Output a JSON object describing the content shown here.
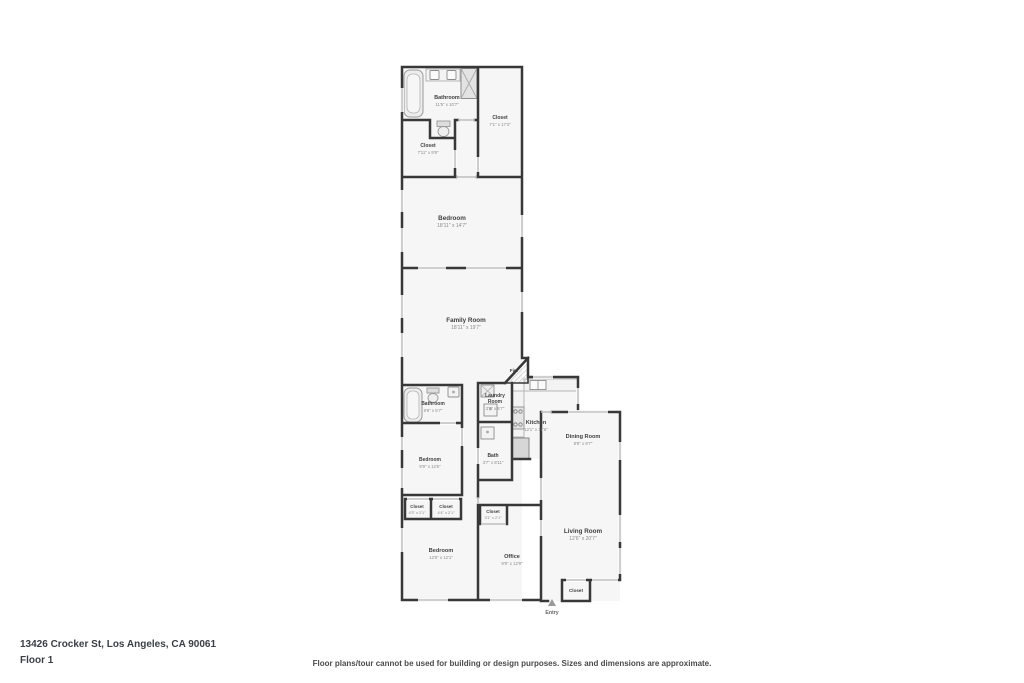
{
  "colors": {
    "wall": "#383838",
    "room_fill": "#f6f6f6",
    "window": "#cfcfcf",
    "door": "#bdbdbd",
    "label_name": "#3f3f3f",
    "label_dims": "#8a8a8a"
  },
  "floorplan": {
    "rooms": {
      "bathroom_top": {
        "name": "Bathroom",
        "dims": "11'5\" x 10'7\""
      },
      "closet_top_right": {
        "name": "Closet",
        "dims": "7'1\" x 17'3\""
      },
      "closet_top_left": {
        "name": "Closet",
        "dims": "7'11\" x 9'9\""
      },
      "bedroom_top": {
        "name": "Bedroom",
        "dims": "18'11\" x 14'7\""
      },
      "family_room": {
        "name": "Family Room",
        "dims": "18'11\" x 19'7\""
      },
      "fire": {
        "name": "Fire"
      },
      "laundry": {
        "name_line1": "Laundry",
        "name_line2": "Room",
        "dims": "3'7\" x 5'7\""
      },
      "kitchen": {
        "name": "Kitchen",
        "dims": "12'1\" x 17'6\""
      },
      "bathroom_mid": {
        "name": "Bathroom",
        "dims": "9'9\" x 5'7\""
      },
      "bath": {
        "name": "Bath",
        "dims": "3'7\" x 8'11\""
      },
      "dining_room": {
        "name": "Dining Room",
        "dims": "8'8\" x 9'7\""
      },
      "bedroom_mid": {
        "name": "Bedroom",
        "dims": "9'9\" x 12'5\""
      },
      "closet_a": {
        "name": "Closet",
        "dims": "4'3\" x 2'1\""
      },
      "closet_b": {
        "name": "Closet",
        "dims": "4'4\" x 2'1\""
      },
      "closet_c": {
        "name": "Closet",
        "dims": "3'1\" x 2'1\""
      },
      "bedroom_bottom": {
        "name": "Bedroom",
        "dims": "12'5\" x 12'1\""
      },
      "office": {
        "name": "Office",
        "dims": "9'9\" x 12'9\""
      },
      "living_room": {
        "name": "Living Room",
        "dims": "12'6\" x 20'7\""
      },
      "closet_entry": {
        "name": "Closet"
      },
      "entry": {
        "name": "Entry"
      }
    }
  },
  "footer": {
    "address": "13426 Crocker St, Los Angeles, CA 90061",
    "floor": "Floor 1",
    "disclaimer": "Floor plans/tour cannot be used for building or design purposes. Sizes and dimensions are approximate."
  }
}
